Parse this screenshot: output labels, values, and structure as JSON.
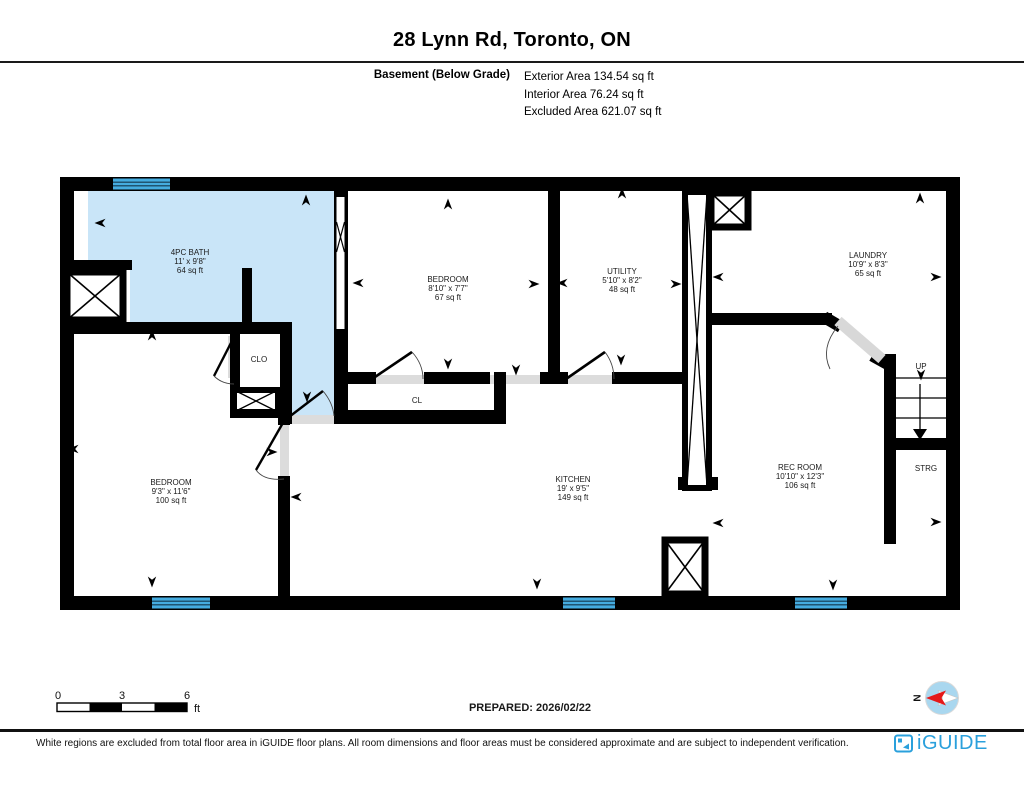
{
  "page": {
    "title": "28 Lynn Rd, Toronto, ON"
  },
  "floor_info": {
    "label": "Basement (Below Grade)",
    "exterior_area": "Exterior Area 134.54 sq ft",
    "interior_area": "Interior Area 76.24 sq ft",
    "excluded_area": "Excluded Area 621.07 sq ft"
  },
  "rooms": {
    "bath": {
      "name": "4PC BATH",
      "dims": "11' x 9'8\"",
      "area": "64 sq ft"
    },
    "bedroom_top": {
      "name": "BEDROOM",
      "dims": "8'10\" x 7'7\"",
      "area": "67 sq ft"
    },
    "utility": {
      "name": "UTILITY",
      "dims": "5'10\" x 8'2\"",
      "area": "48 sq ft"
    },
    "laundry": {
      "name": "LAUNDRY",
      "dims": "10'9\" x 8'3\"",
      "area": "65 sq ft"
    },
    "bedroom_left": {
      "name": "BEDROOM",
      "dims": "9'3\" x 11'6\"",
      "area": "100 sq ft"
    },
    "kitchen": {
      "name": "KITCHEN",
      "dims": "19' x 9'5\"",
      "area": "149 sq ft"
    },
    "rec_room": {
      "name": "REC ROOM",
      "dims": "10'10\" x 12'3\"",
      "area": "106 sq ft"
    },
    "closet1": "CLO",
    "closet2": "CL",
    "stairs_up": "UP",
    "storage": "STRG"
  },
  "scale_bar": {
    "tick0": "0",
    "tick1": "3",
    "tick2": "6",
    "unit": "ft"
  },
  "prepared_label": "PREPARED: 2026/02/22",
  "compass_label": "N",
  "footer": {
    "disclaimer": "White regions are excluded from total floor area in iGUIDE floor plans. All room dimensions and floor areas must be considered approximate and are subject to independent verification.",
    "brand": "iGUIDE"
  },
  "colors": {
    "room_highlight": "#c9e5f8",
    "window_blue": "#45ace0",
    "brand_blue": "#2aa0dc",
    "compass_red": "#e51818",
    "compass_blue": "#a9d7ef"
  }
}
